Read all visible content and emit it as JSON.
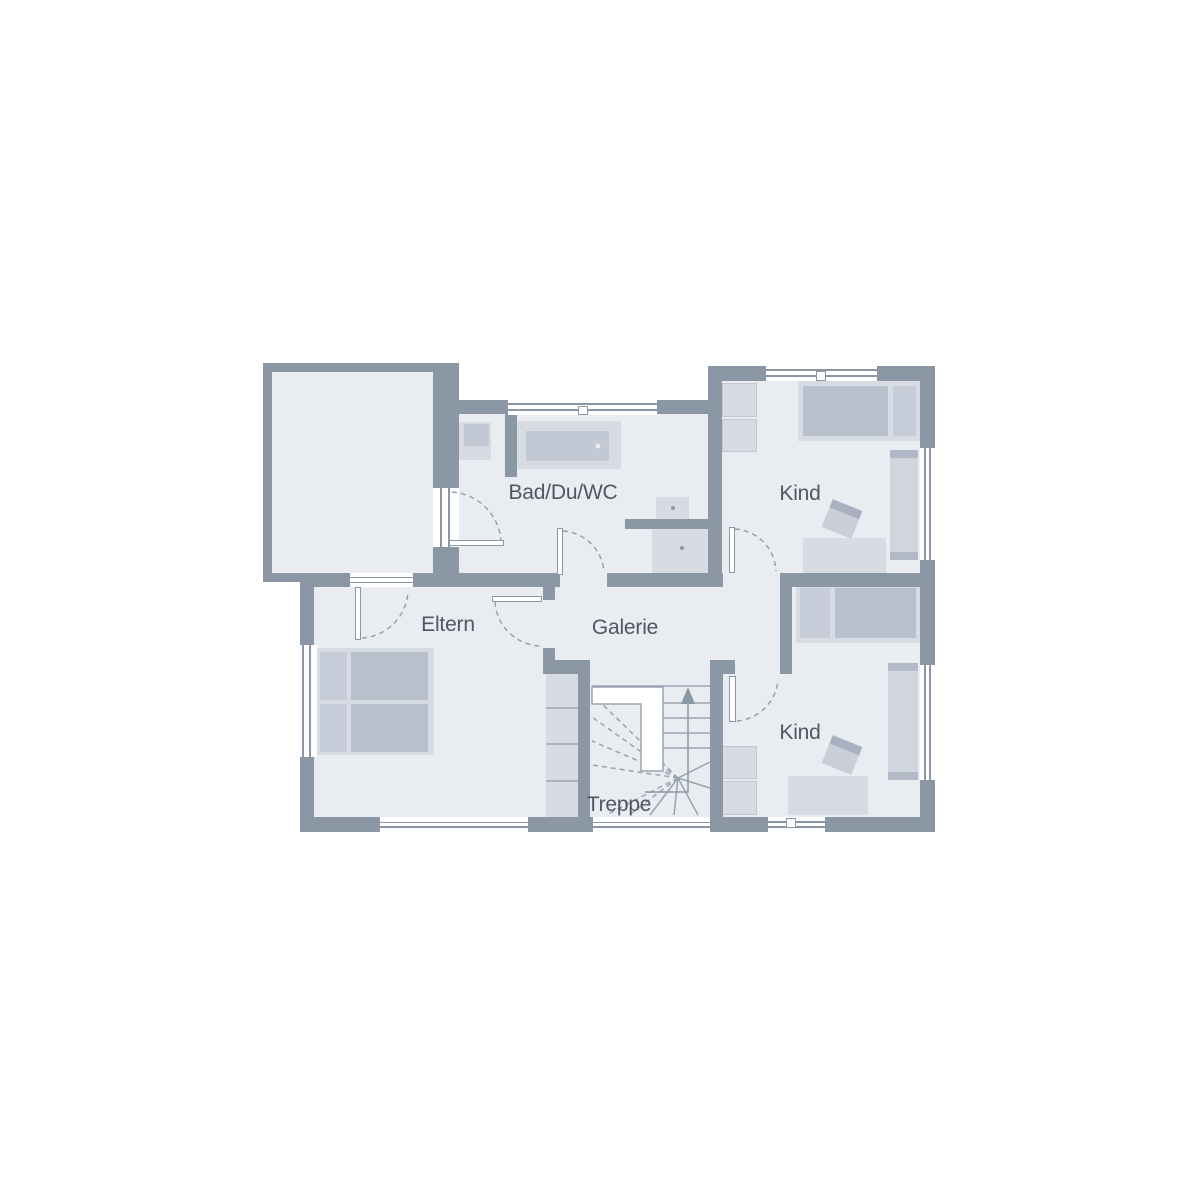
{
  "floorplan": {
    "type": "upper-floor-plan",
    "rooms": [
      {
        "id": "bath",
        "label": "Bad/Du/WC"
      },
      {
        "id": "child1",
        "label": "Kind"
      },
      {
        "id": "parents",
        "label": "Eltern"
      },
      {
        "id": "gallery",
        "label": "Galerie"
      },
      {
        "id": "child2",
        "label": "Kind"
      },
      {
        "id": "stairs",
        "label": "Treppe"
      }
    ],
    "colors": {
      "background": "#ffffff",
      "wall": "#8c97a6",
      "room_fill": "#e9ecf1",
      "furniture_light": "#d7dbe3",
      "furniture_mid": "#c7cdd8",
      "furniture_dark": "#b9c0cd",
      "line": "#9aa3b1",
      "text": "#4e5764"
    }
  }
}
